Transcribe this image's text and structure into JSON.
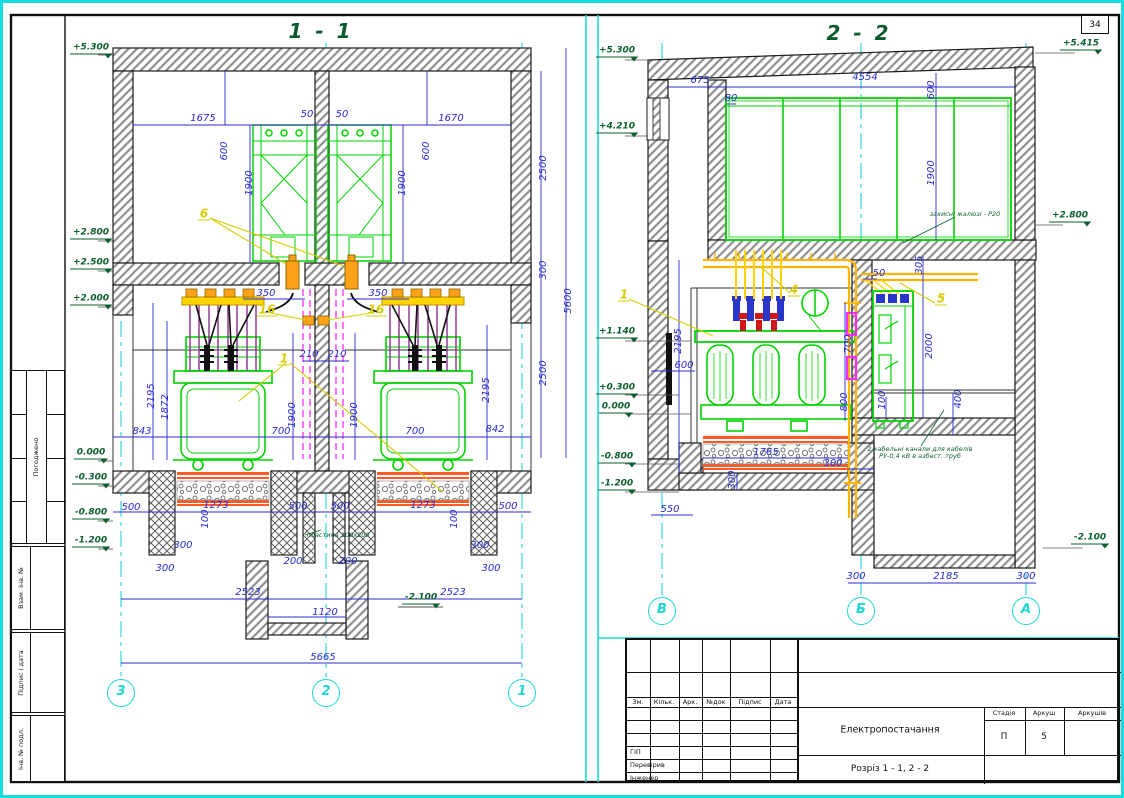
{
  "page": {
    "sheet_number": "34"
  },
  "colors": {
    "axis_cyan": "#1fd6d6",
    "dim_blue": "#2a2ad0",
    "equip_green": "#00d400",
    "elev_green": "#0b5e2e",
    "callout_yellow": "#d6cc00",
    "rail_orange": "#ff5a28",
    "bushing_orange": "#ffa21a",
    "magenta": "#ff2bff",
    "wall_hatch": "#909090"
  },
  "side_stamp": {
    "approved": "Погоджено",
    "fields": [
      "Взам. інв. №",
      "Підпис і дата",
      "Інв. № подл."
    ]
  },
  "title_block": {
    "cols": [
      "Зм.",
      "Кільк.",
      "Арк.",
      "№док",
      "Підпис",
      "Дата"
    ],
    "rows": [
      "ГІП",
      "Перевірив",
      "Інженер"
    ],
    "project_title": "Електропостачання",
    "drawing_title": "Розріз 1 - 1, 2 - 2",
    "stage_cols": [
      "Стадія",
      "Аркуш",
      "Аркушів"
    ],
    "stage": "П",
    "sheet": "5",
    "sheets_total": ""
  },
  "sections": [
    {
      "name": "section-1-1",
      "title": "1 - 1",
      "axis_bubbles": [
        {
          "label": "3",
          "x": 118,
          "y": 690
        },
        {
          "label": "2",
          "x": 323,
          "y": 690
        },
        {
          "label": "1",
          "x": 519,
          "y": 690
        }
      ],
      "labels": [
        {
          "t": "1 - 1",
          "x": 318,
          "y": 28,
          "c": "title"
        },
        {
          "t": "1675",
          "x": 200,
          "y": 116,
          "c": "dim"
        },
        {
          "t": "50",
          "x": 304,
          "y": 112,
          "c": "dim"
        },
        {
          "t": "50",
          "x": 339,
          "y": 112,
          "c": "dim"
        },
        {
          "t": "1670",
          "x": 448,
          "y": 116,
          "c": "dim"
        },
        {
          "t": "600",
          "x": 222,
          "y": 148,
          "c": "dimv"
        },
        {
          "t": "600",
          "x": 424,
          "y": 148,
          "c": "dimv"
        },
        {
          "t": "1900",
          "x": 247,
          "y": 180,
          "c": "dimv"
        },
        {
          "t": "1900",
          "x": 400,
          "y": 180,
          "c": "dimv"
        },
        {
          "t": "2500",
          "x": 541,
          "y": 165,
          "c": "dimv"
        },
        {
          "t": "300",
          "x": 541,
          "y": 267,
          "c": "dimv"
        },
        {
          "t": "2500",
          "x": 541,
          "y": 370,
          "c": "dimv"
        },
        {
          "t": "5600",
          "x": 566,
          "y": 298,
          "c": "dimv"
        },
        {
          "t": "350",
          "x": 263,
          "y": 291,
          "c": "dim"
        },
        {
          "t": "350",
          "x": 375,
          "y": 291,
          "c": "dim"
        },
        {
          "t": "16",
          "x": 264,
          "y": 307,
          "c": "callout"
        },
        {
          "t": "16",
          "x": 373,
          "y": 307,
          "c": "callout"
        },
        {
          "t": "210",
          "x": 306,
          "y": 352,
          "c": "dim"
        },
        {
          "t": "210",
          "x": 334,
          "y": 352,
          "c": "dim"
        },
        {
          "t": "1900",
          "x": 290,
          "y": 412,
          "c": "dimv"
        },
        {
          "t": "1900",
          "x": 352,
          "y": 412,
          "c": "dimv"
        },
        {
          "t": "2195",
          "x": 149,
          "y": 393,
          "c": "dimv"
        },
        {
          "t": "1872",
          "x": 163,
          "y": 404,
          "c": "dimv"
        },
        {
          "t": "2195",
          "x": 484,
          "y": 387,
          "c": "dimv"
        },
        {
          "t": "843",
          "x": 139,
          "y": 429,
          "c": "dim"
        },
        {
          "t": "700",
          "x": 278,
          "y": 429,
          "c": "dim"
        },
        {
          "t": "700",
          "x": 412,
          "y": 429,
          "c": "dim"
        },
        {
          "t": "842",
          "x": 492,
          "y": 427,
          "c": "dim"
        },
        {
          "t": "500",
          "x": 128,
          "y": 505,
          "c": "dim"
        },
        {
          "t": "1273",
          "x": 213,
          "y": 503,
          "c": "dim"
        },
        {
          "t": "500",
          "x": 295,
          "y": 504,
          "c": "dim"
        },
        {
          "t": "500",
          "x": 337,
          "y": 504,
          "c": "dim"
        },
        {
          "t": "1273",
          "x": 420,
          "y": 503,
          "c": "dim"
        },
        {
          "t": "500",
          "x": 505,
          "y": 504,
          "c": "dim"
        },
        {
          "t": "100",
          "x": 203,
          "y": 516,
          "c": "dimv"
        },
        {
          "t": "100",
          "x": 452,
          "y": 516,
          "c": "dimv"
        },
        {
          "t": "300",
          "x": 180,
          "y": 543,
          "c": "dim"
        },
        {
          "t": "300",
          "x": 477,
          "y": 543,
          "c": "dim"
        },
        {
          "t": "300",
          "x": 162,
          "y": 566,
          "c": "dim"
        },
        {
          "t": "300",
          "x": 488,
          "y": 566,
          "c": "dim"
        },
        {
          "t": "200",
          "x": 290,
          "y": 559,
          "c": "dim"
        },
        {
          "t": "200",
          "x": 345,
          "y": 559,
          "c": "dim"
        },
        {
          "t": "2523",
          "x": 245,
          "y": 590,
          "c": "dim"
        },
        {
          "t": "2523",
          "x": 450,
          "y": 590,
          "c": "dim"
        },
        {
          "t": "1120",
          "x": 322,
          "y": 610,
          "c": "dim"
        },
        {
          "t": "5665",
          "x": 320,
          "y": 655,
          "c": "dim"
        },
        {
          "t": "пластина 100х200",
          "x": 335,
          "y": 532,
          "c": "note"
        },
        {
          "t": "+5.300",
          "x": 88,
          "y": 46,
          "c": "elev"
        },
        {
          "t": "+2.800",
          "x": 88,
          "y": 231,
          "c": "elev"
        },
        {
          "t": "+2.500",
          "x": 88,
          "y": 261,
          "c": "elev"
        },
        {
          "t": "+2.000",
          "x": 88,
          "y": 297,
          "c": "elev"
        },
        {
          "t": "0.000",
          "x": 88,
          "y": 451,
          "c": "elev"
        },
        {
          "t": "-0.300",
          "x": 88,
          "y": 476,
          "c": "elev"
        },
        {
          "t": "-0.800",
          "x": 88,
          "y": 511,
          "c": "elev"
        },
        {
          "t": "-1.200",
          "x": 88,
          "y": 539,
          "c": "elev"
        },
        {
          "t": "-2.100",
          "x": 418,
          "y": 596,
          "c": "elev"
        },
        {
          "t": "6",
          "x": 201,
          "y": 211,
          "c": "callout"
        },
        {
          "t": "1",
          "x": 281,
          "y": 356,
          "c": "callout"
        }
      ]
    },
    {
      "name": "section-2-2",
      "title": "2 - 2",
      "axis_bubbles": [
        {
          "label": "В",
          "x": 659,
          "y": 608
        },
        {
          "label": "Б",
          "x": 858,
          "y": 608
        },
        {
          "label": "А",
          "x": 1023,
          "y": 608
        }
      ],
      "labels": [
        {
          "t": "2 - 2",
          "x": 856,
          "y": 30,
          "c": "title"
        },
        {
          "t": "675",
          "x": 697,
          "y": 78,
          "c": "dim"
        },
        {
          "t": "4554",
          "x": 862,
          "y": 75,
          "c": "dim"
        },
        {
          "t": "80",
          "x": 728,
          "y": 96,
          "c": "dim"
        },
        {
          "t": "600",
          "x": 929,
          "y": 87,
          "c": "dimv"
        },
        {
          "t": "1900",
          "x": 929,
          "y": 170,
          "c": "dimv"
        },
        {
          "t": "2195",
          "x": 676,
          "y": 338,
          "c": "dimv"
        },
        {
          "t": "600",
          "x": 681,
          "y": 363,
          "c": "dim"
        },
        {
          "t": "700",
          "x": 846,
          "y": 341,
          "c": "dimv"
        },
        {
          "t": "800",
          "x": 842,
          "y": 399,
          "c": "dimv"
        },
        {
          "t": "1765",
          "x": 763,
          "y": 450,
          "c": "dim"
        },
        {
          "t": "300",
          "x": 730,
          "y": 477,
          "c": "dimv"
        },
        {
          "t": "300",
          "x": 830,
          "y": 461,
          "c": "dim"
        },
        {
          "t": "550",
          "x": 667,
          "y": 507,
          "c": "dim"
        },
        {
          "t": "50",
          "x": 876,
          "y": 271,
          "c": "dim"
        },
        {
          "t": "305",
          "x": 917,
          "y": 262,
          "c": "dimv"
        },
        {
          "t": "2000",
          "x": 927,
          "y": 343,
          "c": "dimv"
        },
        {
          "t": "100",
          "x": 880,
          "y": 397,
          "c": "dimv"
        },
        {
          "t": "400",
          "x": 956,
          "y": 396,
          "c": "dimv"
        },
        {
          "t": "300",
          "x": 853,
          "y": 574,
          "c": "dim"
        },
        {
          "t": "2185",
          "x": 943,
          "y": 574,
          "c": "dim"
        },
        {
          "t": "300",
          "x": 1023,
          "y": 574,
          "c": "dim"
        },
        {
          "t": "+5.300",
          "x": 614,
          "y": 49,
          "c": "elev"
        },
        {
          "t": "+4.210",
          "x": 614,
          "y": 125,
          "c": "elev"
        },
        {
          "t": "+5.415",
          "x": 1078,
          "y": 42,
          "c": "elev"
        },
        {
          "t": "+2.800",
          "x": 1067,
          "y": 214,
          "c": "elev"
        },
        {
          "t": "+1.140",
          "x": 614,
          "y": 330,
          "c": "elev"
        },
        {
          "t": "+0.300",
          "x": 614,
          "y": 386,
          "c": "elev"
        },
        {
          "t": "0.000",
          "x": 613,
          "y": 405,
          "c": "elev"
        },
        {
          "t": "-0.800",
          "x": 614,
          "y": 455,
          "c": "elev"
        },
        {
          "t": "-1.200",
          "x": 614,
          "y": 482,
          "c": "elev"
        },
        {
          "t": "-2.100",
          "x": 1087,
          "y": 536,
          "c": "elev"
        },
        {
          "t": "1",
          "x": 621,
          "y": 292,
          "c": "callout"
        },
        {
          "t": "4",
          "x": 791,
          "y": 287,
          "c": "callout"
        },
        {
          "t": "5",
          "x": 938,
          "y": 296,
          "c": "callout"
        },
        {
          "t": "захисні жалюзі - Р20",
          "x": 962,
          "y": 211,
          "c": "note"
        },
        {
          "t": "2 кабельні канали для кабелів",
          "x": 917,
          "y": 446,
          "c": "note"
        },
        {
          "t": "РУ-0,4 кВ в азбест. труб",
          "x": 917,
          "y": 453,
          "c": "note"
        }
      ]
    }
  ]
}
